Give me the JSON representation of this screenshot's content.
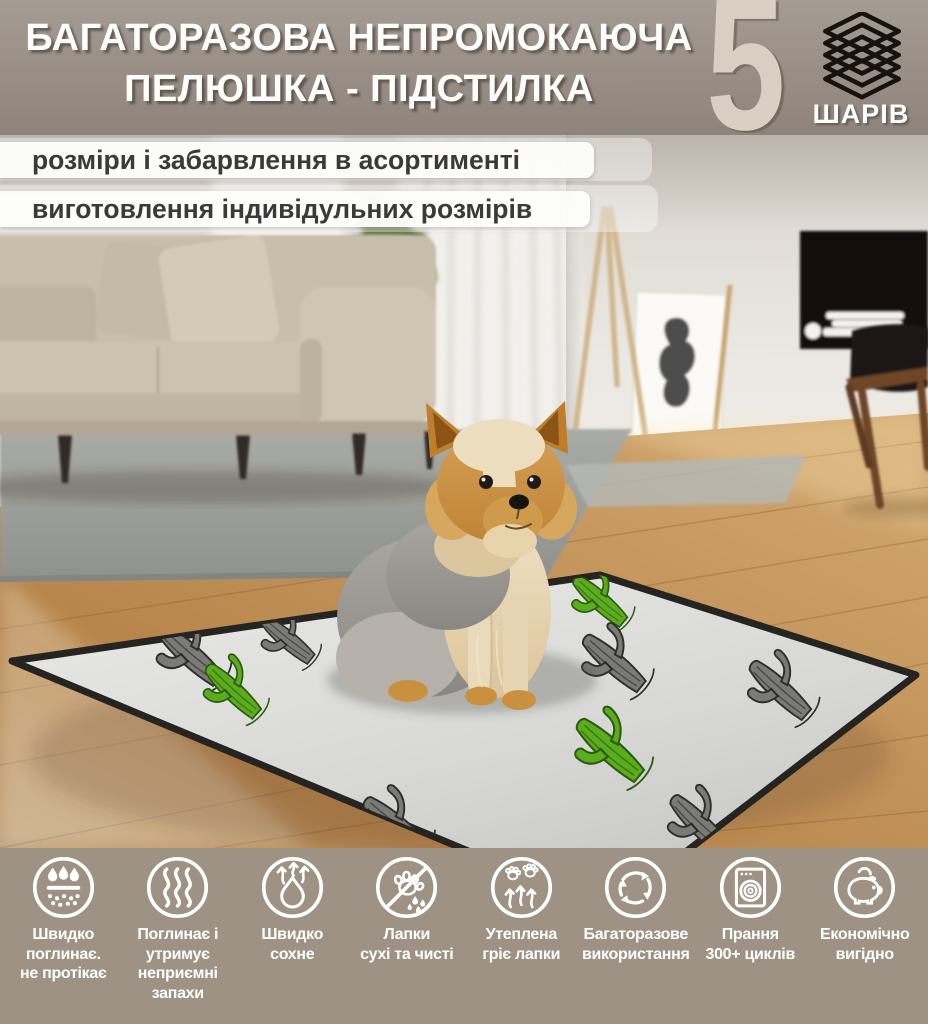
{
  "header": {
    "title_line1": "БАГАТОРАЗОВА НЕПРОМОКАЮЧА",
    "title_line2": "ПЕЛЮШКА - ПІДСТИЛКА",
    "badge": {
      "number": "5",
      "label": "ШАРІВ",
      "icon": "layers-stack-icon"
    }
  },
  "banners": [
    {
      "text": "розміри і забарвлення в асортименті"
    },
    {
      "text": "виготовлення індивідульних розмірів"
    }
  ],
  "features": [
    {
      "icon": "water-drops-absorb-icon",
      "label": "Швидко\nпоглинає.\nне протікає"
    },
    {
      "icon": "odor-waves-icon",
      "label": "Поглинає і\nутримує\nнеприємні\nзапахи"
    },
    {
      "icon": "quick-dry-drop-icon",
      "label": "Швидко\nсохне"
    },
    {
      "icon": "no-wet-paws-icon",
      "label": "Лапки\nсухі та чисті"
    },
    {
      "icon": "warm-paws-icon",
      "label": "Утеплена\nгріє лапки"
    },
    {
      "icon": "reuse-cycle-icon",
      "label": "Багаторазове\nвикористання"
    },
    {
      "icon": "washing-machine-icon",
      "label": "Прання\n300+ циклів"
    },
    {
      "icon": "piggy-bank-icon",
      "label": "Економічно\nвигідно"
    }
  ],
  "pad_pattern": {
    "icons": [
      "cactus-icon"
    ],
    "cactus_colors": [
      "#7a7a76",
      "#5cad1e"
    ]
  },
  "colors": {
    "header_bg": "#988e86",
    "footer_bg": "#9e9285",
    "badge_number": "#d9cfc3",
    "badge_icon": "#16120d",
    "title_text": "#ffffff",
    "banner_bg": "#fdfdfc",
    "banner_text": "#3a3a3a",
    "feature_icon_stroke": "#ffffff",
    "pad_surface": "#dcdcda",
    "pad_edge": "#262420",
    "cactus_green": "#5cad1e",
    "cactus_grey": "#7a7a76",
    "wood_floor": "#c0955e",
    "sofa": "#c9bfad",
    "rug": "#a0a29d"
  }
}
